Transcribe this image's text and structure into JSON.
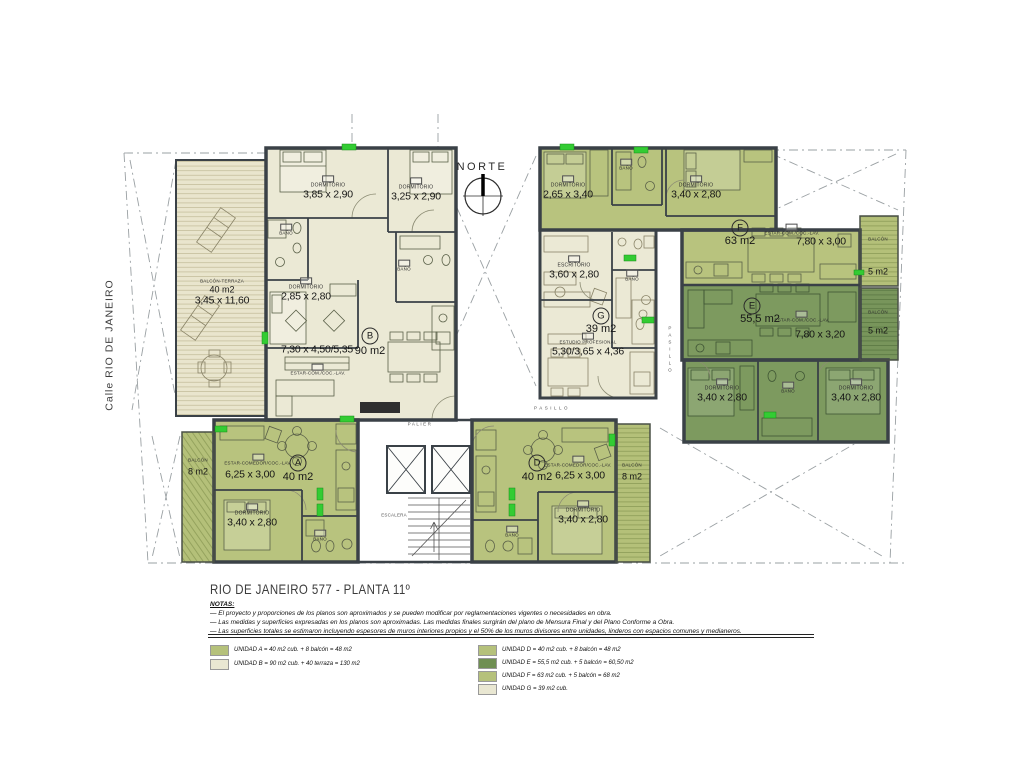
{
  "colors": {
    "olive": "#b8c37e",
    "cream": "#ebe9d5",
    "dark_green": "#7d9a5f",
    "legend_olive": "#b5c17b",
    "legend_cream": "#e9e7d2",
    "legend_dark": "#6f8f52",
    "wall": "#3a4147",
    "marker_green": "#33cc33"
  },
  "plan": {
    "street": "Calle  RIO DE JANEIRO",
    "north": "NORTE",
    "palier": "PALIER",
    "escalera": "ESCALERA",
    "pasillo": "PASILLO",
    "rooms": {
      "dormitorio": "DORMITORIO",
      "bano": "BAÑO",
      "escritorio": "ESCRITORIO",
      "estudio": "ESTUDIO PROFESIONAL",
      "estar_com": "ESTAR-COM./COC.-LAV.",
      "estar_comedor": "ESTAR-COMEDOR/COC.-LAV.",
      "balcon": "BALCÓN",
      "balcon_terraza": "BALCÓN-TERRAZA"
    },
    "units": {
      "a": {
        "letter": "A",
        "area": "40 m2",
        "estar_dim": "6,25 x 3,00",
        "dorm_dim": "3,40 x 2,80",
        "balcon_area": "8 m2"
      },
      "b": {
        "letter": "B",
        "area": "90 m2",
        "estar_dim": "7,30 x 4,50/5,35",
        "dorm1_dim": "3,85 x 2,90",
        "dorm2_dim": "3,25 x 2,90",
        "dorm3_dim": "2,85 x 2,80",
        "terraza_area": "40 m2",
        "terraza_dim": "3,45 x 11,60"
      },
      "d": {
        "letter": "D",
        "area": "40 m2",
        "estar_dim": "6,25 x 3,00",
        "dorm_dim": "3,40 x 2,80",
        "balcon_area": "8 m2"
      },
      "e": {
        "letter": "E",
        "area": "55,5 m2",
        "estar_dim": "7,80 x 3,20",
        "dorm_dim": "3,40 x 2,80",
        "balcon_area": "5 m2"
      },
      "f": {
        "letter": "F",
        "area": "63 m2",
        "estar_dim": "7,80 x 3,00",
        "dorm1_dim": "2,65 x 3,40",
        "dorm2_dim": "3,40 x 2,80",
        "balcon_area": "5 m2"
      },
      "g": {
        "letter": "G",
        "area": "39 m2",
        "main_dim": "5,30/3,65 x 4,36",
        "escritorio_dim": "3,60 x 2,80"
      }
    }
  },
  "title_block": {
    "title": "RIO DE JANEIRO 577 - PLANTA 11º",
    "notes_heading": "NOTAS:",
    "notes": [
      "—  El proyecto y proporciones de los planos son aproximados y se pueden modificar por reglamentaciones vigentes o necesidades en obra.",
      "—  Las medidas y superficies expresadas en los planos son aproximadas. Las medidas finales surgirán del plano de Mensura Final y del Plano Conforme a Obra.",
      "—  Las superficies totales se estimaron incluyendo espesores de muros interiores propios y el 50% de los muros divisores entre unidades, linderos con espacios comunes y medianeros."
    ]
  },
  "legend": {
    "left": [
      {
        "label": "UNIDAD A  =  40 m2 cub.  +  8 balcón  =  48 m2",
        "color": "#b5c17b"
      },
      {
        "label": "UNIDAD B  =  90 m2 cub.  +  40 terraza  =  130 m2",
        "color": "#e9e7d2"
      }
    ],
    "right": [
      {
        "label": "UNIDAD D  =  40 m2 cub.  +  8 balcón  =  48 m2",
        "color": "#b5c17b"
      },
      {
        "label": "UNIDAD E  =  55,5 m2 cub.  +  5 balcón  =  60,50 m2",
        "color": "#6f8f52"
      },
      {
        "label": "UNIDAD F  =  63 m2 cub.  +  5 balcón  =  68 m2",
        "color": "#b5c17b"
      },
      {
        "label": "UNIDAD G  =  39 m2 cub.",
        "color": "#e9e7d2"
      }
    ]
  }
}
